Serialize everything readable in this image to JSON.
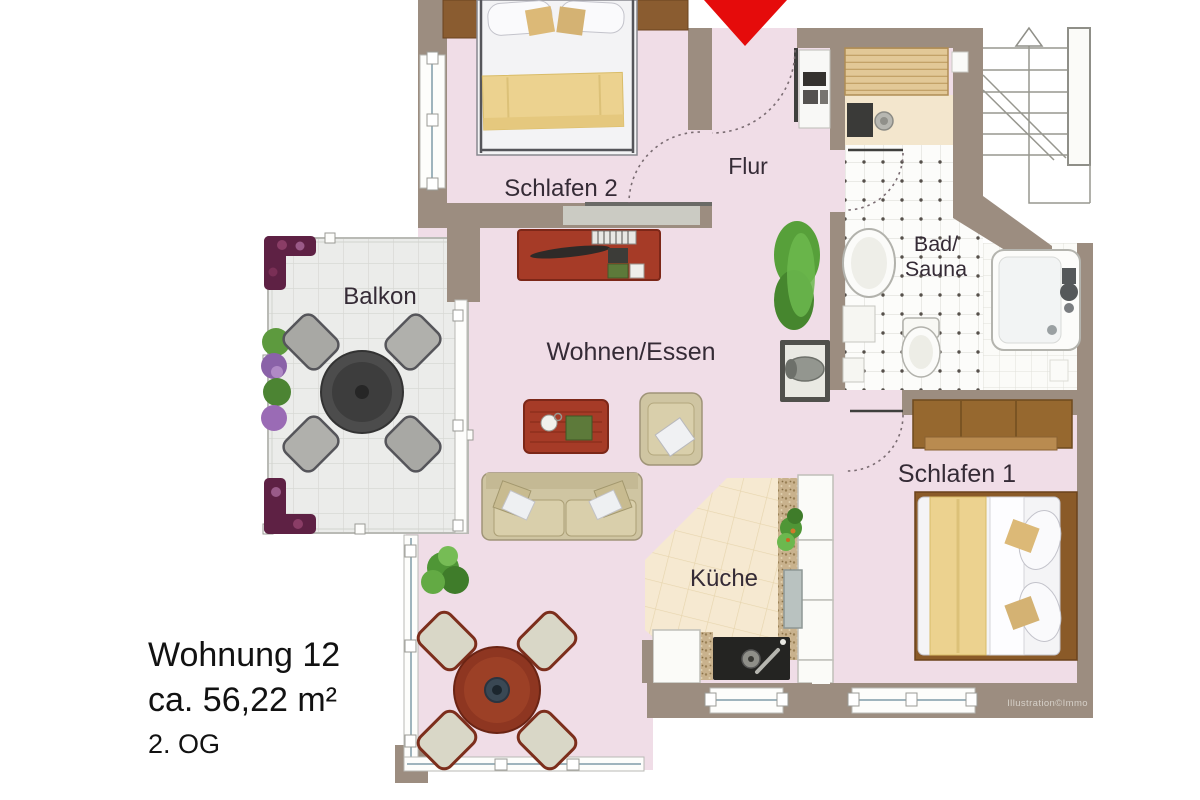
{
  "plan": {
    "rooms": {
      "schlafen2": "Schlafen 2",
      "flur": "Flur",
      "bad_line1": "Bad/",
      "bad_line2": "Sauna",
      "balkon": "Balkon",
      "wohnen_essen": "Wohnen/Essen",
      "kueche": "Küche",
      "schlafen1": "Schlafen 1"
    },
    "watermark": "Illustration©Immo",
    "entrance_marker": "red-arrow-down",
    "stairs_marker": "stairs-up-arrow"
  },
  "caption": {
    "title": "Wohnung 12",
    "area": "ca. 56,22 m²",
    "floor": "2. OG"
  },
  "colors": {
    "wall": "#9c8d80",
    "floor_pink": "#f0dde7",
    "balcony_tile": "#ebecea",
    "kitchen_tile": "#f6e9d1",
    "bath_tile": "#fcfcfa",
    "entrance_arrow_red": "#e50b0b",
    "wood_brown": "#96682f",
    "furniture_red": "#a63b27",
    "sofa_beige": "#cfc5a2",
    "blanket_yellow": "#ecd28f",
    "label_text": "#352b36",
    "caption_text": "#121212"
  }
}
